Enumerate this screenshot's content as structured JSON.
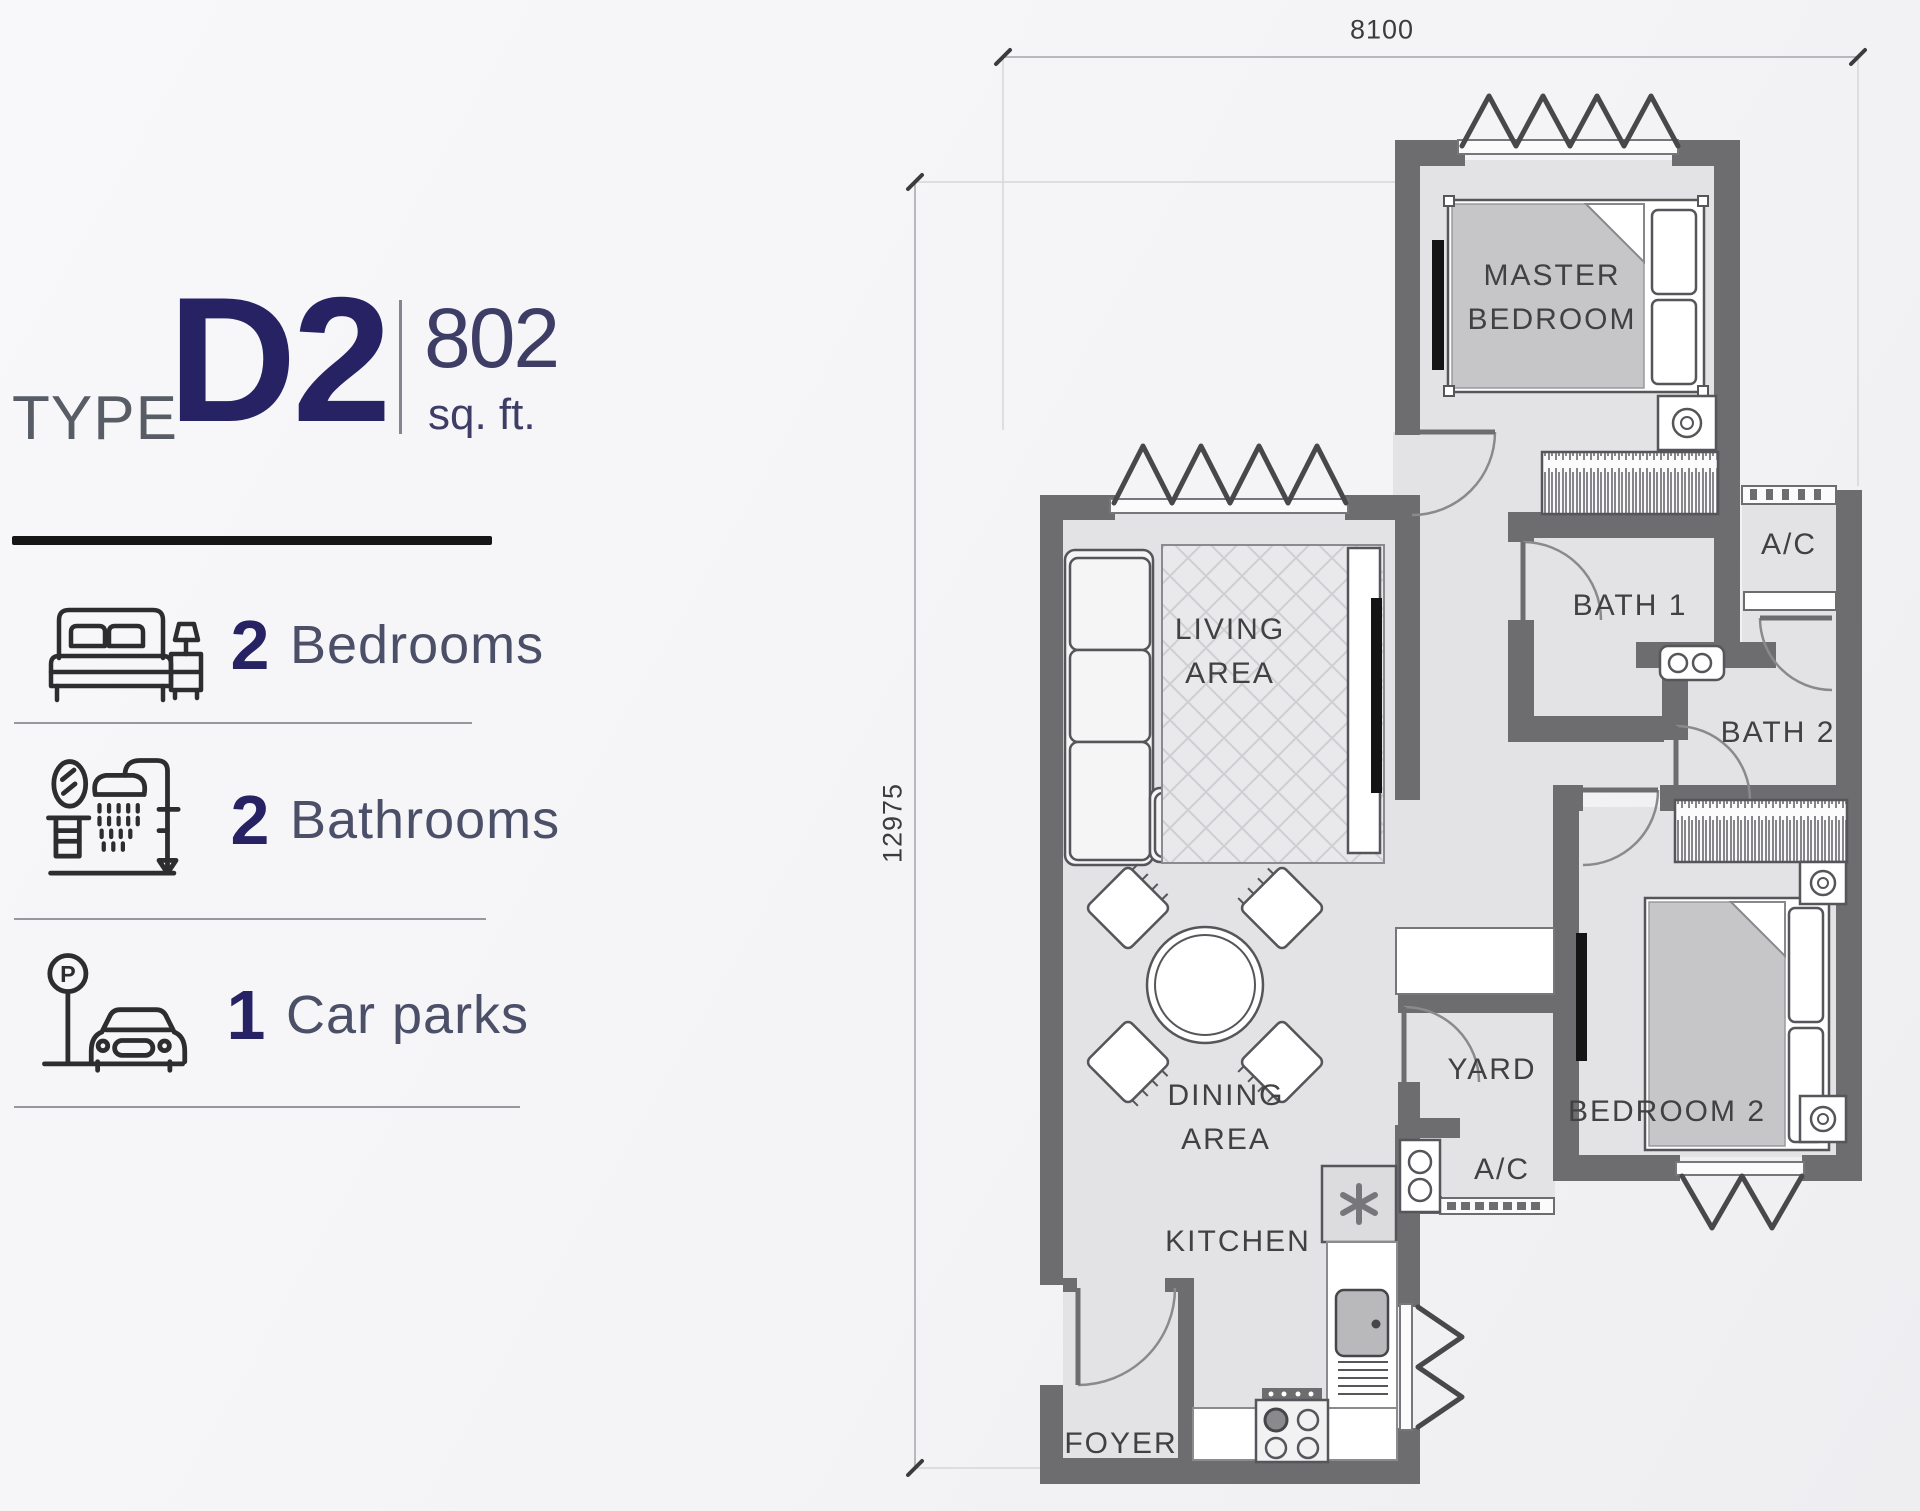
{
  "header": {
    "type_label": "TYPE",
    "type_code": "D2",
    "area_value": "802",
    "area_unit": "sq. ft."
  },
  "legend": {
    "items": [
      {
        "count": "2",
        "label": "Bedrooms",
        "icon": "bed-icon"
      },
      {
        "count": "2",
        "label": "Bathrooms",
        "icon": "shower-icon"
      },
      {
        "count": "1",
        "label": "Car parks",
        "icon": "car-park-icon",
        "sign_letter": "P"
      }
    ]
  },
  "plan": {
    "dimensions": {
      "top": "8100",
      "left": "12975"
    },
    "rooms": {
      "master_bedroom": {
        "line1": "MASTER",
        "line2": "BEDROOM"
      },
      "living_area": {
        "line1": "LIVING",
        "line2": "AREA"
      },
      "dining_area": {
        "line1": "DINING",
        "line2": "AREA"
      },
      "bath1": {
        "label": "BATH 1"
      },
      "ac_upper": {
        "label": "A/C"
      },
      "bath2": {
        "label": "BATH 2"
      },
      "yard": {
        "label": "YARD"
      },
      "ac_lower": {
        "label": "A/C"
      },
      "bedroom2": {
        "label": "BEDROOM 2"
      },
      "kitchen": {
        "label": "KITCHEN"
      },
      "foyer": {
        "label": "FOYER"
      }
    }
  },
  "colors": {
    "accent_navy": "#262264",
    "wall_gray": "#6d6d70",
    "floor_gray": "#e3e3e5",
    "label_text": "#414143"
  }
}
